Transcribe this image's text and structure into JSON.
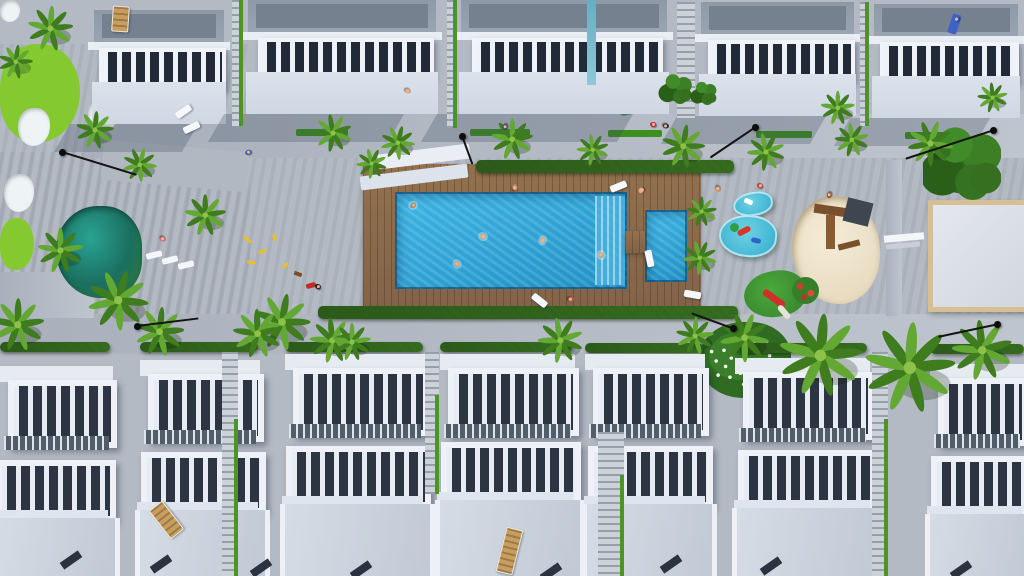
{
  "scene": {
    "label": "3D aerial rendering of a white residential complex: two rows of townhouses with pergola roof terraces around a central garden with wooden pool deck, turquoise swimming pool, kids pool, pond, golf green, playgrounds, palm trees and promenades",
    "colors": {
      "lawn": "#4e8b1f",
      "lawn_light": "#85c930",
      "bunker": "#eef3f5",
      "pool": "#2ea7da",
      "pool_steps": "#4ab2de",
      "deck": "#8a6850",
      "pond": "#1b6f60",
      "path": "#b4bac4",
      "roof": "#8e99a7",
      "roof_dark": "#76818f",
      "building_white": "#e9edf4",
      "wall": "#d6dde8",
      "slat_dark": "#2c3541",
      "terrace_light": "#ccd3dd",
      "hedge": "#2f5c1c",
      "palm_light": "#63a832",
      "palm_dark": "#3e7c1e",
      "sand": "#ecdfc6",
      "court_border": "#d6c093",
      "lamp": "#0d0d0d",
      "lounger_white": "#f6f9fc",
      "lounger_wood": "#c69e60",
      "splash": "#3fbcd8",
      "canopy_teal": "#47908c",
      "toy_yellow": "#e8c11c"
    },
    "regions": {
      "lawn_left": [
        0,
        44,
        250,
        280
      ],
      "lawn_main": [
        0,
        152,
        1024,
        166
      ],
      "path_top": [
        84,
        114,
        940,
        44
      ],
      "path_top_left_diag": [
        102,
        146,
        146,
        40,
        5
      ],
      "path_bottom": [
        0,
        314,
        1024,
        40
      ],
      "path_left_ext": [
        0,
        272,
        94,
        46
      ],
      "path_right_stub": [
        886,
        160,
        16,
        156
      ]
    },
    "golf": {
      "greens": [
        [
          0,
          44,
          80,
          98
        ],
        [
          0,
          218,
          34,
          52
        ]
      ],
      "bunkers": [
        [
          0,
          0,
          20,
          22
        ],
        [
          88,
          98,
          30,
          34
        ],
        [
          18,
          108,
          32,
          38
        ],
        [
          4,
          174,
          30,
          38
        ]
      ]
    },
    "pond": [
      56,
      206,
      86,
      92
    ],
    "deck": [
      363,
      164,
      338,
      152
    ],
    "hedges": [
      [
        476,
        160,
        258,
        13
      ],
      [
        318,
        306,
        420,
        13
      ]
    ],
    "pool": {
      "main": [
        395,
        192,
        232,
        97
      ],
      "steps": [
        595,
        196,
        30,
        89
      ],
      "small": [
        645,
        210,
        42,
        72
      ],
      "connector": [
        625,
        231,
        22,
        22
      ]
    },
    "court": [
      928,
      200,
      98,
      102
    ],
    "court_bench": [
      [
        884,
        234,
        40,
        7,
        "#f4f7fa",
        -5
      ],
      [
        886,
        243,
        34,
        5,
        "#c9cfd8",
        -5
      ]
    ],
    "sandpit": [
      792,
      196,
      88,
      108
    ],
    "sandpit_wood": [
      [
        814,
        206,
        34,
        9,
        "#7a4f2c",
        8
      ],
      [
        826,
        215,
        9,
        34,
        "#8a5a33",
        0
      ],
      [
        845,
        200,
        26,
        24,
        "#3e4650",
        14
      ],
      [
        838,
        242,
        22,
        6,
        "#7a4f2c",
        -14
      ]
    ],
    "splash_pools": [
      [
        733,
        192,
        40,
        24,
        -8
      ],
      [
        719,
        215,
        58,
        42,
        6
      ]
    ],
    "splash_toys": [
      [
        744,
        199,
        9,
        5,
        "#ffffff",
        24,
        "2px"
      ],
      [
        737,
        228,
        14,
        6,
        "#d93527",
        -28,
        "3px"
      ],
      [
        751,
        238,
        10,
        5,
        "#2f63c9",
        12,
        "3px"
      ],
      [
        730,
        223,
        9,
        9,
        "#2f9e47",
        0,
        "50%"
      ]
    ],
    "minigolf": [
      744,
      271,
      62,
      46
    ],
    "minigolf_slide": [
      [
        761,
        295,
        26,
        7,
        "#cf2f27",
        36,
        "4px"
      ],
      [
        776,
        309,
        16,
        6,
        "#e7e3da",
        50,
        "3px"
      ]
    ],
    "red_flowers": [
      792,
      277,
      27,
      27
    ],
    "flower_bush": [
      699,
      322,
      92,
      76
    ],
    "misc_rects": [
      [
        378,
        149,
        92,
        15,
        "#eaeef4",
        -7,
        "2px"
      ],
      [
        360,
        170,
        108,
        14,
        "#dde3ec",
        -7,
        "2px"
      ],
      [
        617,
        86,
        42,
        26,
        "#47908c",
        -14,
        "4px"
      ],
      [
        296,
        129,
        52,
        7,
        "#3f8f1f",
        0,
        "2px"
      ],
      [
        470,
        129,
        60,
        7,
        "#3f8f1f",
        0,
        "2px"
      ],
      [
        608,
        130,
        54,
        7,
        "#3f8f1f",
        0,
        "2px"
      ],
      [
        756,
        131,
        56,
        7,
        "#3f8f1f",
        0,
        "2px"
      ],
      [
        905,
        132,
        60,
        7,
        "#3f8f1f",
        0,
        "2px"
      ],
      [
        146,
        252,
        16,
        6,
        "#f4f7fa",
        -14,
        "2px"
      ],
      [
        162,
        257,
        16,
        6,
        "#f4f7fa",
        -14,
        "2px"
      ],
      [
        178,
        262,
        16,
        6,
        "#f4f7fa",
        -14,
        "2px"
      ],
      [
        243,
        238,
        9,
        3,
        "#e8c11c",
        40,
        "1px"
      ],
      [
        258,
        250,
        8,
        3,
        "#e8c11c",
        -20,
        "1px"
      ],
      [
        271,
        236,
        7,
        3,
        "#e8c11c",
        70,
        "1px"
      ],
      [
        247,
        261,
        9,
        3,
        "#e8c11c",
        10,
        "1px"
      ],
      [
        282,
        264,
        7,
        3,
        "#e8c11c",
        -45,
        "1px"
      ],
      [
        294,
        272,
        8,
        4,
        "#7a4f2c",
        20,
        "1px"
      ],
      [
        306,
        283,
        10,
        5,
        "#c42b20",
        -15,
        "2px"
      ]
    ],
    "top_buildings": [
      [
        88,
        142,
        10
      ],
      [
        242,
        200,
        0
      ],
      [
        455,
        218,
        0
      ],
      [
        695,
        165,
        2
      ],
      [
        868,
        156,
        4
      ]
    ],
    "top_alleys": [
      [
        232,
        0,
        11,
        126,
        1
      ],
      [
        447,
        0,
        10,
        128,
        1
      ],
      [
        677,
        2,
        18,
        116,
        0
      ],
      [
        860,
        2,
        9,
        124,
        1
      ]
    ],
    "bottom_hedges": [
      [
        0,
        342,
        110
      ],
      [
        140,
        342,
        118
      ],
      [
        285,
        342,
        138
      ],
      [
        440,
        342,
        132
      ],
      [
        585,
        343,
        118
      ],
      [
        735,
        343,
        132
      ],
      [
        930,
        344,
        94
      ]
    ],
    "row1": [
      [
        0,
        113,
        12
      ],
      [
        140,
        120,
        6
      ],
      [
        285,
        140,
        0
      ],
      [
        440,
        135,
        0
      ],
      [
        585,
        120,
        0
      ],
      [
        735,
        135,
        4
      ],
      [
        930,
        94,
        10
      ]
    ],
    "row2": [
      [
        -10,
        120,
        18
      ],
      [
        135,
        125,
        10
      ],
      [
        280,
        145,
        4
      ],
      [
        435,
        140,
        0
      ],
      [
        582,
        125,
        4
      ],
      [
        732,
        140,
        8
      ],
      [
        925,
        99,
        14
      ]
    ],
    "bottom_alleys": [
      [
        222,
        352,
        16,
        224,
        1
      ],
      [
        425,
        352,
        14,
        142,
        1
      ],
      [
        598,
        432,
        26,
        144,
        1
      ],
      [
        872,
        352,
        16,
        224,
        1
      ]
    ],
    "door_marks": [
      [
        60,
        556
      ],
      [
        150,
        560
      ],
      [
        250,
        564
      ],
      [
        350,
        566
      ],
      [
        540,
        568
      ],
      [
        660,
        560
      ],
      [
        760,
        562
      ],
      [
        950,
        566
      ]
    ],
    "trees": [
      [
        962,
        165,
        2.2
      ],
      [
        676,
        90,
        0.9
      ],
      [
        704,
        94,
        0.7
      ]
    ],
    "palms": [
      [
        333,
        133,
        1.0
      ],
      [
        398,
        143,
        0.9
      ],
      [
        512,
        139,
        1.1
      ],
      [
        593,
        150,
        0.85
      ],
      [
        683,
        146,
        1.15
      ],
      [
        766,
        152,
        1.0
      ],
      [
        852,
        140,
        0.9
      ],
      [
        930,
        143,
        1.2
      ],
      [
        993,
        98,
        0.8
      ],
      [
        50,
        28,
        1.2
      ],
      [
        16,
        62,
        0.9
      ],
      [
        95,
        130,
        1.0
      ],
      [
        140,
        165,
        0.9
      ],
      [
        118,
        300,
        1.6
      ],
      [
        160,
        332,
        1.3
      ],
      [
        60,
        250,
        1.2
      ],
      [
        205,
        215,
        1.1
      ],
      [
        18,
        325,
        1.4
      ],
      [
        282,
        322,
        1.5
      ],
      [
        332,
        340,
        1.2
      ],
      [
        372,
        164,
        0.8
      ],
      [
        700,
        258,
        0.9
      ],
      [
        702,
        212,
        0.8
      ],
      [
        838,
        108,
        0.9
      ],
      [
        820,
        355,
        2.2
      ],
      [
        910,
        368,
        2.4
      ],
      [
        982,
        350,
        1.6
      ],
      [
        745,
        338,
        1.3
      ],
      [
        258,
        334,
        1.3
      ],
      [
        352,
        342,
        1.0
      ],
      [
        560,
        340,
        1.2
      ],
      [
        695,
        336,
        1.0
      ]
    ],
    "lamps": [
      [
        62,
        152,
        17,
        78
      ],
      [
        462,
        136,
        70,
        30
      ],
      [
        755,
        127,
        146,
        54
      ],
      [
        993,
        130,
        162,
        92
      ],
      [
        137,
        326,
        -7,
        62
      ],
      [
        733,
        328,
        200,
        44
      ],
      [
        997,
        324,
        168,
        60
      ]
    ],
    "white_loungers": [
      [
        610,
        183,
        -22
      ],
      [
        531,
        297,
        38
      ],
      [
        684,
        291,
        10
      ],
      [
        641,
        255,
        78
      ],
      [
        175,
        108,
        -35
      ],
      [
        183,
        124,
        -25
      ]
    ],
    "wood_loungers": [
      [
        501,
        528,
        14,
        44
      ],
      [
        158,
        502,
        -38,
        34
      ],
      [
        112,
        6,
        4,
        24
      ]
    ],
    "towel": [
      950,
      14,
      18
    ],
    "people": [
      [
        413,
        205,
        "#b8825f",
        1
      ],
      [
        483,
        236,
        "#e0a87c",
        1
      ],
      [
        543,
        240,
        "#e0a87c",
        1
      ],
      [
        457,
        264,
        "#d8a070",
        1
      ],
      [
        601,
        255,
        "#d8a070",
        1
      ],
      [
        515,
        187,
        "#c8906a",
        0
      ],
      [
        641,
        190,
        "#e0a87c",
        0
      ],
      [
        571,
        299,
        "#b05a4a",
        0
      ],
      [
        505,
        127,
        "#3a4a66",
        0
      ],
      [
        653,
        124,
        "#c03028",
        0
      ],
      [
        666,
        126,
        "#2a3440",
        0
      ],
      [
        248,
        152,
        "#2f62c4",
        0
      ],
      [
        163,
        239,
        "#d06a84",
        0
      ],
      [
        318,
        286,
        "#20262e",
        0
      ],
      [
        718,
        189,
        "#c88a5a",
        0
      ],
      [
        829,
        195,
        "#8a5a3a",
        0
      ],
      [
        956,
        19,
        "#3f62c8",
        0
      ],
      [
        408,
        91,
        "#d8a070",
        0
      ],
      [
        760,
        185,
        "#c8443a",
        0
      ]
    ]
  }
}
